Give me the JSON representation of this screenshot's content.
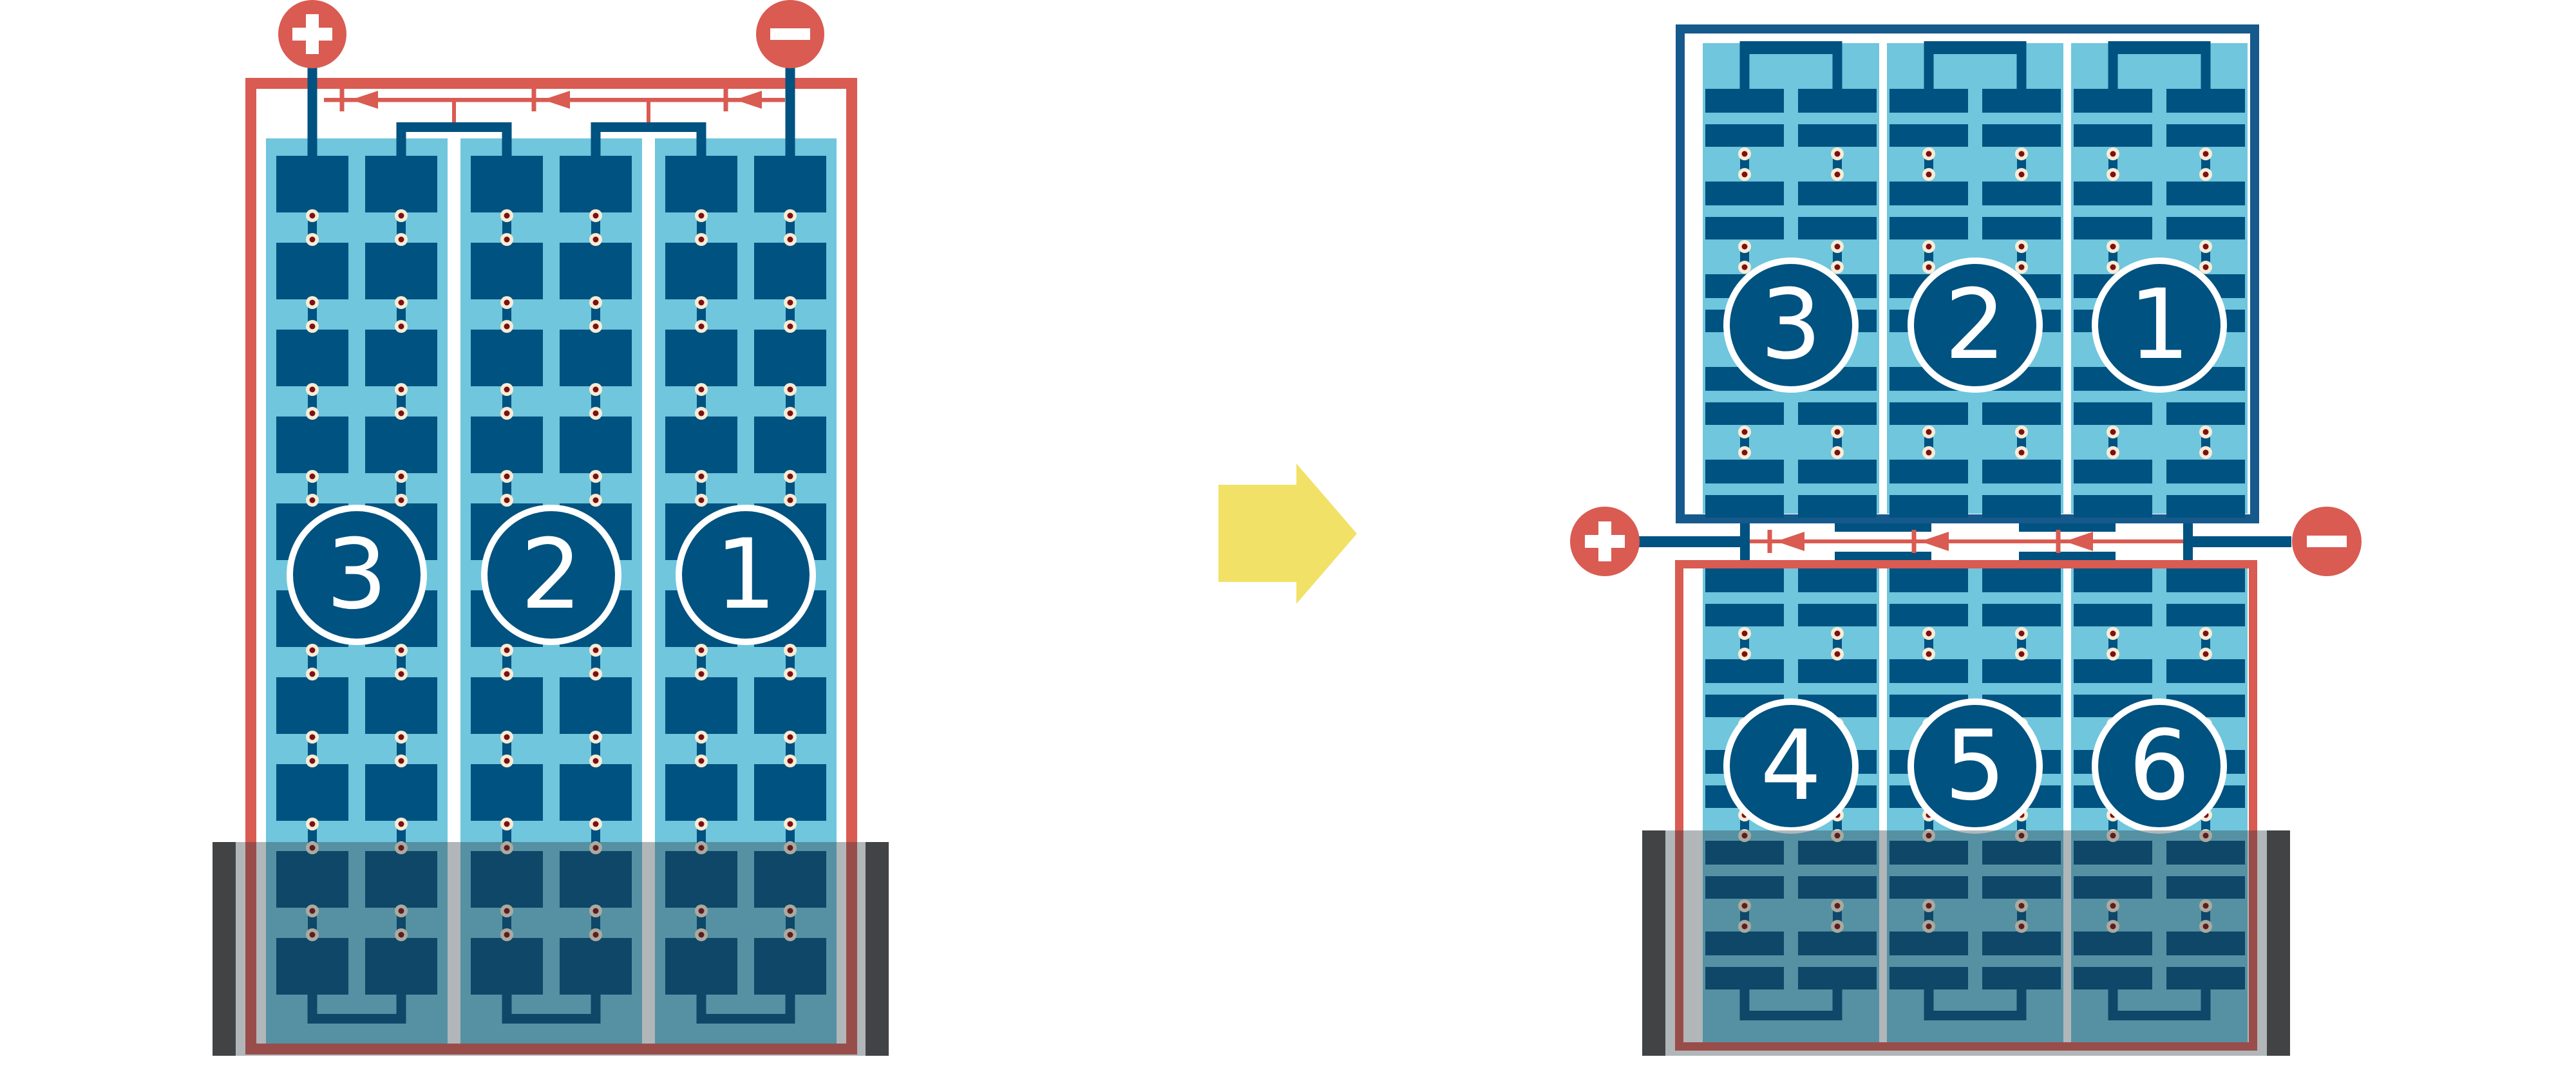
{
  "diagram": {
    "left_unit": {
      "cell_labels": [
        "3",
        "2",
        "1"
      ],
      "positive_terminal": "+",
      "negative_terminal": "−"
    },
    "right_unit": {
      "top_section_cell_labels": [
        "3",
        "2",
        "1"
      ],
      "bottom_section_cell_labels": [
        "4",
        "5",
        "6"
      ],
      "positive_terminal": "+",
      "negative_terminal": "−"
    }
  },
  "colors": {
    "red": "#d95b52",
    "dark_blue": "#005280",
    "frame_blue": "#16598c",
    "light_blue": "#6fc6dd",
    "cream": "#f8ecd5",
    "dot_core": "#7d1013",
    "tank_overlay": "rgba(38,54,62,0.36)",
    "cap_gray": "#414345",
    "yellow": "#f2e167",
    "white": "#ffffff"
  }
}
